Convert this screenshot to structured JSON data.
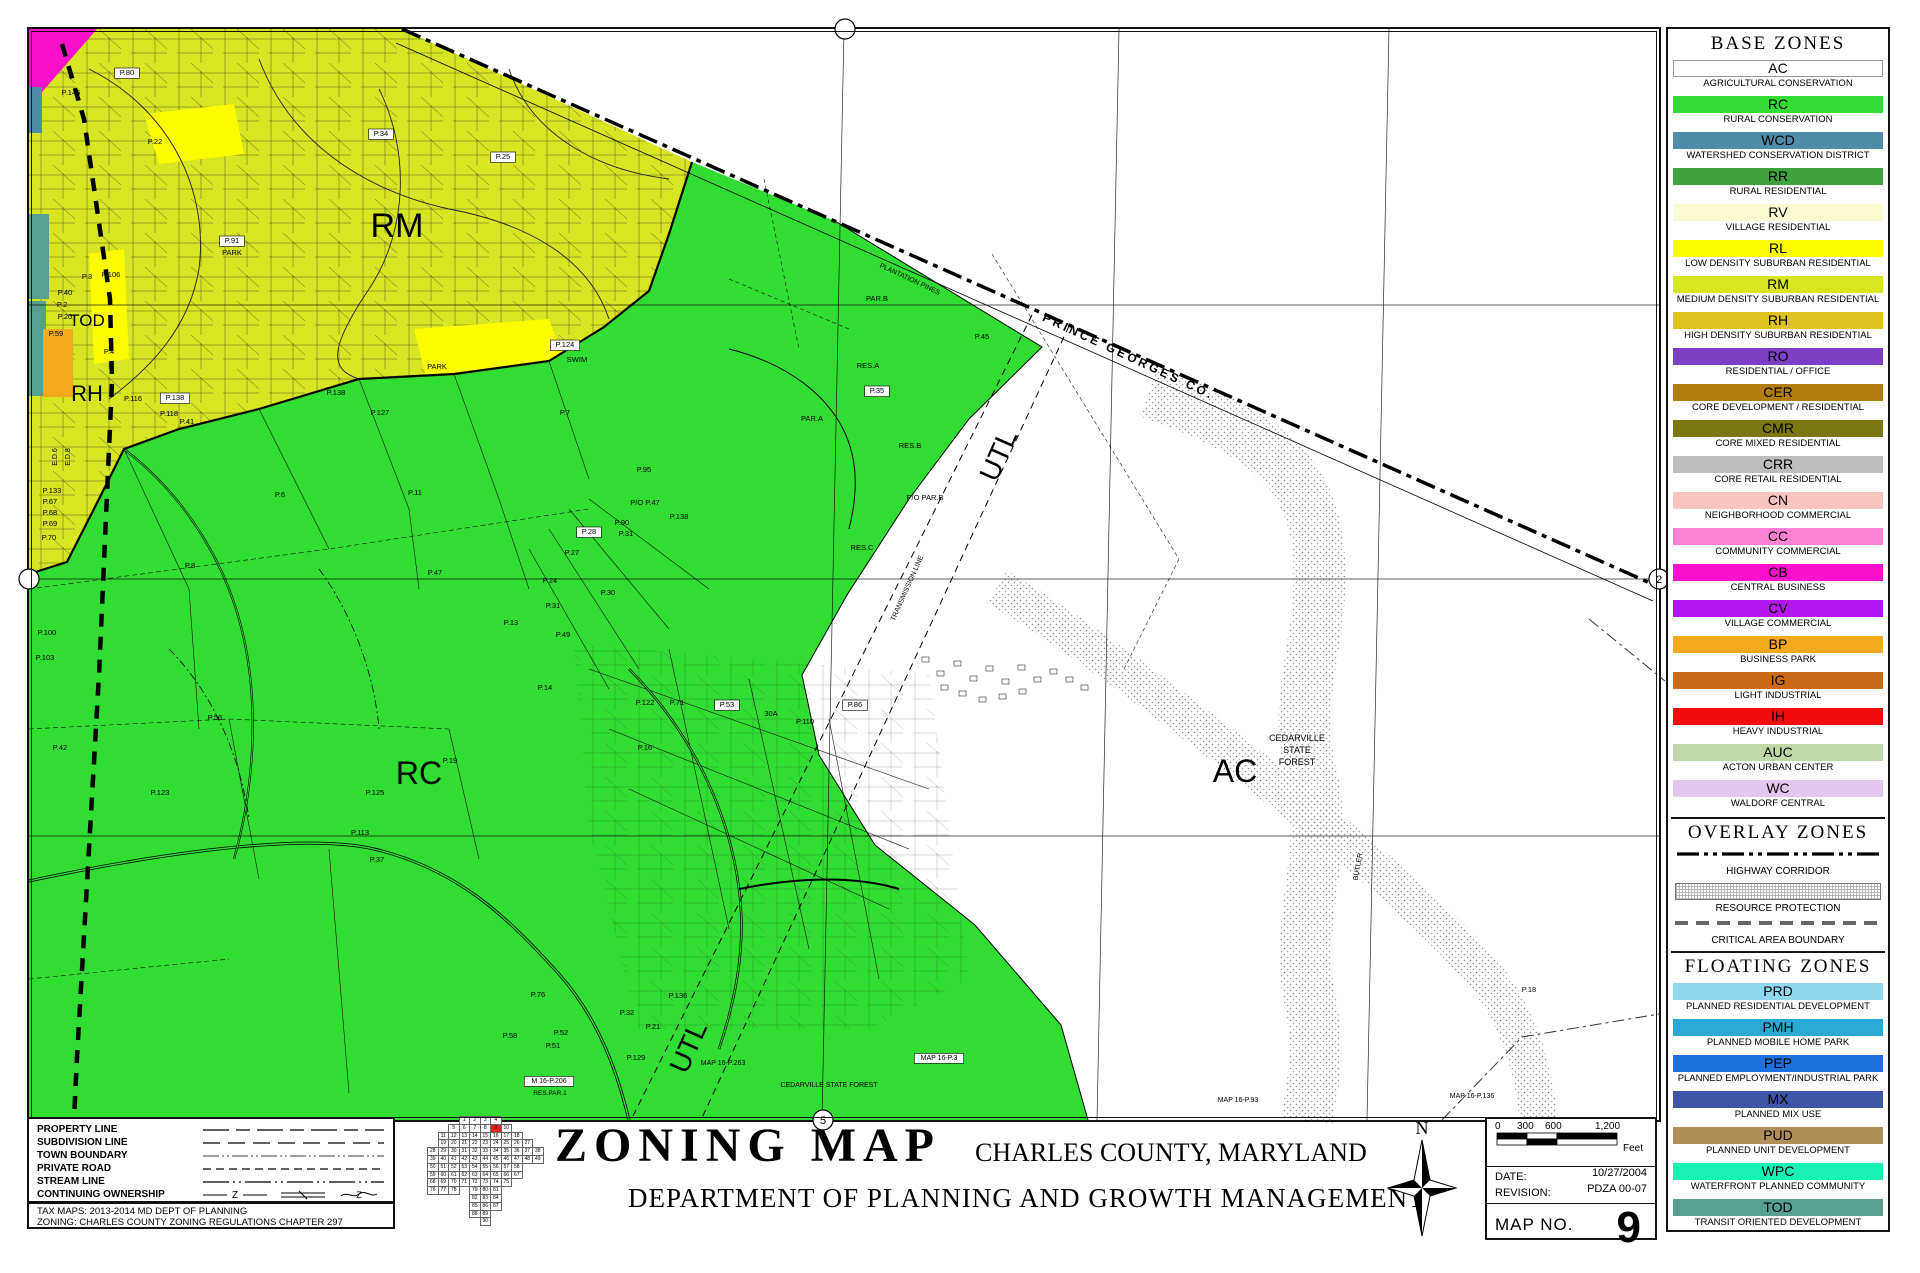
{
  "colors": {
    "ac": "#FFFFFF",
    "rc": "#31DC33",
    "wcd": "#4E8CA8",
    "rr": "#3EA33E",
    "rv": "#FAFAD2",
    "rl": "#FDFD00",
    "rm": "#D7E523",
    "rh": "#E0C31E",
    "ro": "#7C3EC3",
    "cer": "#B07D0E",
    "cmr": "#7A7712",
    "crr": "#BDBDBD",
    "cn": "#F9C4C0",
    "cc": "#FF80D5",
    "cb": "#FA10CC",
    "cv": "#B317EF",
    "bp": "#F3A81E",
    "ig": "#CC6914",
    "ih": "#F20D0D",
    "auc": "#BED8A8",
    "wc": "#E2C6EE",
    "prd": "#8ED9F0",
    "pmh": "#29A9D6",
    "pep": "#1E6FE0",
    "mx": "#3C56A5",
    "pud": "#AF8F57",
    "wpc": "#18F3B4",
    "tod": "#57A08F",
    "highlight": "#E8241C"
  },
  "legend": {
    "base_header": "BASE ZONES",
    "overlay_header": "OVERLAY ZONES",
    "floating_header": "FLOATING ZONES",
    "base": [
      {
        "code": "AC",
        "label": "AGRICULTURAL CONSERVATION",
        "color": "#FFFFFF"
      },
      {
        "code": "RC",
        "label": "RURAL CONSERVATION",
        "color": "#31DC33"
      },
      {
        "code": "WCD",
        "label": "WATERSHED CONSERVATION DISTRICT",
        "color": "#4E8CA8"
      },
      {
        "code": "RR",
        "label": "RURAL RESIDENTIAL",
        "color": "#3EA33E"
      },
      {
        "code": "RV",
        "label": "VILLAGE RESIDENTIAL",
        "color": "#FAFAD2"
      },
      {
        "code": "RL",
        "label": "LOW DENSITY SUBURBAN RESIDENTIAL",
        "color": "#FDFD00"
      },
      {
        "code": "RM",
        "label": "MEDIUM DENSITY SUBURBAN RESIDENTIAL",
        "color": "#D7E523"
      },
      {
        "code": "RH",
        "label": "HIGH DENSITY SUBURBAN RESIDENTIAL",
        "color": "#E0C31E"
      },
      {
        "code": "RO",
        "label": "RESIDENTIAL / OFFICE",
        "color": "#7C3EC3"
      },
      {
        "code": "CER",
        "label": "CORE DEVELOPMENT / RESIDENTIAL",
        "color": "#B07D0E"
      },
      {
        "code": "CMR",
        "label": "CORE MIXED RESIDENTIAL",
        "color": "#7A7712"
      },
      {
        "code": "CRR",
        "label": "CORE RETAIL RESIDENTIAL",
        "color": "#BDBDBD"
      },
      {
        "code": "CN",
        "label": "NEIGHBORHOOD COMMERCIAL",
        "color": "#F9C4C0"
      },
      {
        "code": "CC",
        "label": "COMMUNITY COMMERCIAL",
        "color": "#FF80D5"
      },
      {
        "code": "CB",
        "label": "CENTRAL BUSINESS",
        "color": "#FA10CC"
      },
      {
        "code": "CV",
        "label": "VILLAGE COMMERCIAL",
        "color": "#B317EF"
      },
      {
        "code": "BP",
        "label": "BUSINESS PARK",
        "color": "#F3A81E"
      },
      {
        "code": "IG",
        "label": "LIGHT INDUSTRIAL",
        "color": "#CC6914"
      },
      {
        "code": "IH",
        "label": "HEAVY INDUSTRIAL",
        "color": "#F20D0D"
      },
      {
        "code": "AUC",
        "label": "ACTON URBAN CENTER",
        "color": "#BED8A8"
      },
      {
        "code": "WC",
        "label": "WALDORF CENTRAL",
        "color": "#E2C6EE"
      }
    ],
    "overlays": [
      {
        "label": "HIGHWAY CORRIDOR",
        "style": "dashdot"
      },
      {
        "label": "RESOURCE PROTECTION",
        "style": "hatch"
      },
      {
        "label": "CRITICAL AREA BOUNDARY",
        "style": "dashed"
      }
    ],
    "floating": [
      {
        "code": "PRD",
        "label": "PLANNED RESIDENTIAL DEVELOPMENT",
        "color": "#8ED9F0"
      },
      {
        "code": "PMH",
        "label": "PLANNED MOBILE HOME PARK",
        "color": "#29A9D6"
      },
      {
        "code": "PEP",
        "label": "PLANNED EMPLOYMENT/INDUSTRIAL PARK",
        "color": "#1E6FE0"
      },
      {
        "code": "MX",
        "label": "PLANNED MIX USE",
        "color": "#3C56A5"
      },
      {
        "code": "PUD",
        "label": "PLANNED UNIT DEVELOPMENT",
        "color": "#AF8F57"
      },
      {
        "code": "WPC",
        "label": "WATERFRONT PLANNED COMMUNITY",
        "color": "#18F3B4"
      },
      {
        "code": "TOD",
        "label": "TRANSIT ORIENTED DEVELOPMENT",
        "color": "#57A08F"
      }
    ]
  },
  "line_legend": {
    "rows": [
      {
        "label": "PROPERTY LINE",
        "style": "property"
      },
      {
        "label": "SUBDIVISION LINE",
        "style": "subdivision"
      },
      {
        "label": "TOWN BOUNDARY",
        "style": "town"
      },
      {
        "label": "PRIVATE ROAD",
        "style": "private"
      },
      {
        "label": "STREAM LINE",
        "style": "stream"
      },
      {
        "label": "CONTINUING OWNERSHIP",
        "style": "continuing"
      }
    ],
    "notes": [
      "TAX MAPS: 2013-2014 MD DEPT OF PLANNING",
      "ZONING: CHARLES COUNTY ZONING REGULATIONS CHAPTER 297"
    ]
  },
  "title_block": {
    "title": "ZONING MAP",
    "subtitle": "CHARLES COUNTY, MARYLAND",
    "department": "DEPARTMENT OF PLANNING AND GROWTH MANAGEMENT",
    "compass": "N",
    "scale_ticks": [
      "0",
      "300",
      "600",
      "1,200"
    ],
    "scale_unit": "Feet",
    "date_label": "DATE:",
    "date_value": "10/27/2004",
    "revision_label": "REVISION:",
    "revision_value": "PDZA 00-07",
    "map_no_label": "MAP NO.",
    "map_no_value": "9"
  },
  "index_grid": {
    "highlight": 9,
    "rows": [
      [
        null,
        null,
        null,
        1,
        2,
        3,
        4,
        null,
        null,
        null,
        null
      ],
      [
        null,
        null,
        5,
        6,
        7,
        8,
        9,
        10,
        null,
        null,
        null
      ],
      [
        null,
        11,
        12,
        13,
        14,
        15,
        16,
        17,
        18,
        null,
        null
      ],
      [
        null,
        19,
        20,
        21,
        22,
        23,
        24,
        25,
        26,
        27,
        null
      ],
      [
        28,
        29,
        30,
        31,
        32,
        33,
        34,
        35,
        36,
        37,
        38
      ],
      [
        39,
        40,
        41,
        42,
        43,
        44,
        45,
        46,
        47,
        48,
        49
      ],
      [
        50,
        51,
        52,
        53,
        54,
        55,
        56,
        57,
        58,
        null,
        null
      ],
      [
        59,
        60,
        61,
        62,
        63,
        64,
        65,
        66,
        67,
        null,
        null
      ],
      [
        68,
        69,
        70,
        71,
        72,
        73,
        74,
        75,
        null,
        null,
        null
      ],
      [
        76,
        77,
        78,
        null,
        79,
        80,
        81,
        null,
        null,
        null,
        null
      ],
      [
        null,
        null,
        null,
        null,
        82,
        83,
        84,
        null,
        null,
        null,
        null
      ],
      [
        null,
        null,
        null,
        null,
        85,
        86,
        87,
        null,
        null,
        null,
        null
      ],
      [
        null,
        null,
        null,
        null,
        88,
        89,
        null,
        null,
        null,
        null,
        null
      ],
      [
        null,
        null,
        null,
        null,
        null,
        90,
        null,
        null,
        null,
        null,
        null
      ]
    ]
  },
  "map": {
    "zone_labels": [
      {
        "t": "RM",
        "x": 368,
        "y": 208,
        "s": 34
      },
      {
        "t": "RC",
        "x": 390,
        "y": 755,
        "s": 32
      },
      {
        "t": "AC",
        "x": 1206,
        "y": 753,
        "s": 32
      },
      {
        "t": "TOD",
        "x": 58,
        "y": 297,
        "s": 17
      },
      {
        "t": "RH",
        "x": 58,
        "y": 372,
        "s": 22
      },
      {
        "t": "UTL",
        "x": 978,
        "y": 430,
        "s": 28,
        "r": -66
      },
      {
        "t": "UTL",
        "x": 668,
        "y": 1022,
        "s": 28,
        "r": -66
      }
    ],
    "small_labels": [
      {
        "t": "PRINCE GEORGES CO.",
        "x": 1098,
        "y": 331,
        "r": 25,
        "s": 12,
        "ls": 3,
        "w": 1
      },
      {
        "t": "PLANTATION PINES",
        "x": 880,
        "y": 252,
        "r": 25,
        "s": 7
      },
      {
        "t": "TRANSMISSION LINE",
        "x": 880,
        "y": 560,
        "r": -66,
        "s": 7
      },
      {
        "t": "BUTLER",
        "x": 1331,
        "y": 838,
        "r": -80,
        "s": 7
      },
      {
        "t": "CEDARVILLE",
        "x": 1268,
        "y": 712,
        "s": 9
      },
      {
        "t": "STATE",
        "x": 1268,
        "y": 724,
        "s": 9
      },
      {
        "t": "FOREST",
        "x": 1268,
        "y": 736,
        "s": 9
      },
      {
        "t": "P.80",
        "x": 98,
        "y": 46,
        "b": 1
      },
      {
        "t": "P.145",
        "x": 42,
        "y": 66
      },
      {
        "t": "P.22",
        "x": 126,
        "y": 115
      },
      {
        "t": "P.34",
        "x": 352,
        "y": 107,
        "b": 1
      },
      {
        "t": "P.25",
        "x": 474,
        "y": 130,
        "b": 1
      },
      {
        "t": "P.91",
        "x": 203,
        "y": 214,
        "b": 1
      },
      {
        "t": "PARK",
        "x": 203,
        "y": 226
      },
      {
        "t": "P.106",
        "x": 82,
        "y": 248
      },
      {
        "t": "P.3",
        "x": 58,
        "y": 250
      },
      {
        "t": "P.40",
        "x": 36,
        "y": 266
      },
      {
        "t": "P.2",
        "x": 33,
        "y": 278
      },
      {
        "t": "P.20",
        "x": 36,
        "y": 290
      },
      {
        "t": "P.4",
        "x": 80,
        "y": 325
      },
      {
        "t": "P.59",
        "x": 27,
        "y": 307
      },
      {
        "t": "P.116",
        "x": 104,
        "y": 372
      },
      {
        "t": "P.118",
        "x": 140,
        "y": 387
      },
      {
        "t": "P.41",
        "x": 158,
        "y": 395
      },
      {
        "t": "PARK",
        "x": 408,
        "y": 340
      },
      {
        "t": "SWIM",
        "x": 548,
        "y": 333
      },
      {
        "t": "P.124",
        "x": 536,
        "y": 318,
        "b": 1
      },
      {
        "t": "E.D.6",
        "x": 28,
        "y": 428,
        "r": -90,
        "s": 7
      },
      {
        "t": "E.D.8",
        "x": 41,
        "y": 428,
        "r": -90,
        "s": 7
      },
      {
        "t": "P.133",
        "x": 23,
        "y": 464
      },
      {
        "t": "P.67",
        "x": 21,
        "y": 475
      },
      {
        "t": "P.68",
        "x": 21,
        "y": 486
      },
      {
        "t": "P.69",
        "x": 21,
        "y": 497
      },
      {
        "t": "P.70",
        "x": 20,
        "y": 511
      },
      {
        "t": "P.138",
        "x": 146,
        "y": 371,
        "b": 1
      },
      {
        "t": "P.138",
        "x": 307,
        "y": 366
      },
      {
        "t": "P.127",
        "x": 351,
        "y": 386
      },
      {
        "t": "P.7",
        "x": 536,
        "y": 386
      },
      {
        "t": "P.6",
        "x": 251,
        "y": 468
      },
      {
        "t": "P.8",
        "x": 161,
        "y": 539
      },
      {
        "t": "P.11",
        "x": 386,
        "y": 466
      },
      {
        "t": "P/O P.47",
        "x": 616,
        "y": 476
      },
      {
        "t": "P.138",
        "x": 650,
        "y": 490
      },
      {
        "t": "P.90",
        "x": 593,
        "y": 496
      },
      {
        "t": "P.31",
        "x": 597,
        "y": 507
      },
      {
        "t": "P.28",
        "x": 560,
        "y": 505,
        "b": 1
      },
      {
        "t": "P.27",
        "x": 543,
        "y": 526
      },
      {
        "t": "P.47",
        "x": 406,
        "y": 546
      },
      {
        "t": "P.24",
        "x": 521,
        "y": 554
      },
      {
        "t": "P.30",
        "x": 579,
        "y": 566
      },
      {
        "t": "P.31",
        "x": 524,
        "y": 579
      },
      {
        "t": "P.13",
        "x": 482,
        "y": 596
      },
      {
        "t": "P.49",
        "x": 534,
        "y": 608
      },
      {
        "t": "P.95",
        "x": 615,
        "y": 443
      },
      {
        "t": "P.35",
        "x": 848,
        "y": 364,
        "b": 1
      },
      {
        "t": "PAR.B",
        "x": 848,
        "y": 272
      },
      {
        "t": "RES.A",
        "x": 839,
        "y": 339
      },
      {
        "t": "PAR.A",
        "x": 783,
        "y": 392
      },
      {
        "t": "P.45",
        "x": 953,
        "y": 310
      },
      {
        "t": "RES.B",
        "x": 881,
        "y": 419
      },
      {
        "t": "P/O PAR.B",
        "x": 896,
        "y": 471
      },
      {
        "t": "RES.C",
        "x": 833,
        "y": 521
      },
      {
        "t": "P.122",
        "x": 616,
        "y": 676
      },
      {
        "t": "P.71",
        "x": 648,
        "y": 676
      },
      {
        "t": "P.53",
        "x": 698,
        "y": 678,
        "b": 1
      },
      {
        "t": "P.110",
        "x": 776,
        "y": 695
      },
      {
        "t": "P.86",
        "x": 826,
        "y": 678,
        "b": 1
      },
      {
        "t": "P.14",
        "x": 516,
        "y": 661
      },
      {
        "t": "P.16",
        "x": 616,
        "y": 721
      },
      {
        "t": "P.19",
        "x": 421,
        "y": 734
      },
      {
        "t": "P.56",
        "x": 186,
        "y": 691
      },
      {
        "t": "P.100",
        "x": 18,
        "y": 606
      },
      {
        "t": "P.103",
        "x": 16,
        "y": 631
      },
      {
        "t": "P.42",
        "x": 31,
        "y": 721
      },
      {
        "t": "P.123",
        "x": 131,
        "y": 766
      },
      {
        "t": "P.125",
        "x": 346,
        "y": 766
      },
      {
        "t": "P.113",
        "x": 331,
        "y": 806
      },
      {
        "t": "P.37",
        "x": 348,
        "y": 833
      },
      {
        "t": "30A",
        "x": 742,
        "y": 687
      },
      {
        "t": "P.76",
        "x": 509,
        "y": 968
      },
      {
        "t": "P.58",
        "x": 481,
        "y": 1009
      },
      {
        "t": "P.52",
        "x": 532,
        "y": 1006
      },
      {
        "t": "P.51",
        "x": 524,
        "y": 1019
      },
      {
        "t": "P.32",
        "x": 598,
        "y": 986
      },
      {
        "t": "P.136",
        "x": 649,
        "y": 969
      },
      {
        "t": "P.21",
        "x": 624,
        "y": 1000
      },
      {
        "t": "P.129",
        "x": 607,
        "y": 1031
      },
      {
        "t": "MAP 16-P.263",
        "x": 694,
        "y": 1036,
        "s": 7
      },
      {
        "t": "M 16-P.206",
        "x": 520,
        "y": 1054,
        "b": 1,
        "s": 7
      },
      {
        "t": "RES.PAR.1",
        "x": 521,
        "y": 1066,
        "s": 6.5
      },
      {
        "t": "CEDARVILLE STATE FOREST",
        "x": 800,
        "y": 1058,
        "s": 7
      },
      {
        "t": "MAP 16-P.3",
        "x": 910,
        "y": 1031,
        "b": 1,
        "s": 7
      },
      {
        "t": "MAP 16-P.136",
        "x": 1443,
        "y": 1069,
        "s": 7
      },
      {
        "t": "MAP 16-P.93",
        "x": 1209,
        "y": 1073,
        "s": 7
      },
      {
        "t": "P.18",
        "x": 1500,
        "y": 963
      }
    ],
    "edge_markers": [
      {
        "x": 816,
        "y": 0,
        "l": ""
      },
      {
        "x": 794,
        "y": 1091,
        "l": "5"
      },
      {
        "x": 0,
        "y": 550,
        "l": ""
      },
      {
        "x": 1630,
        "y": 550,
        "l": "2"
      }
    ]
  }
}
